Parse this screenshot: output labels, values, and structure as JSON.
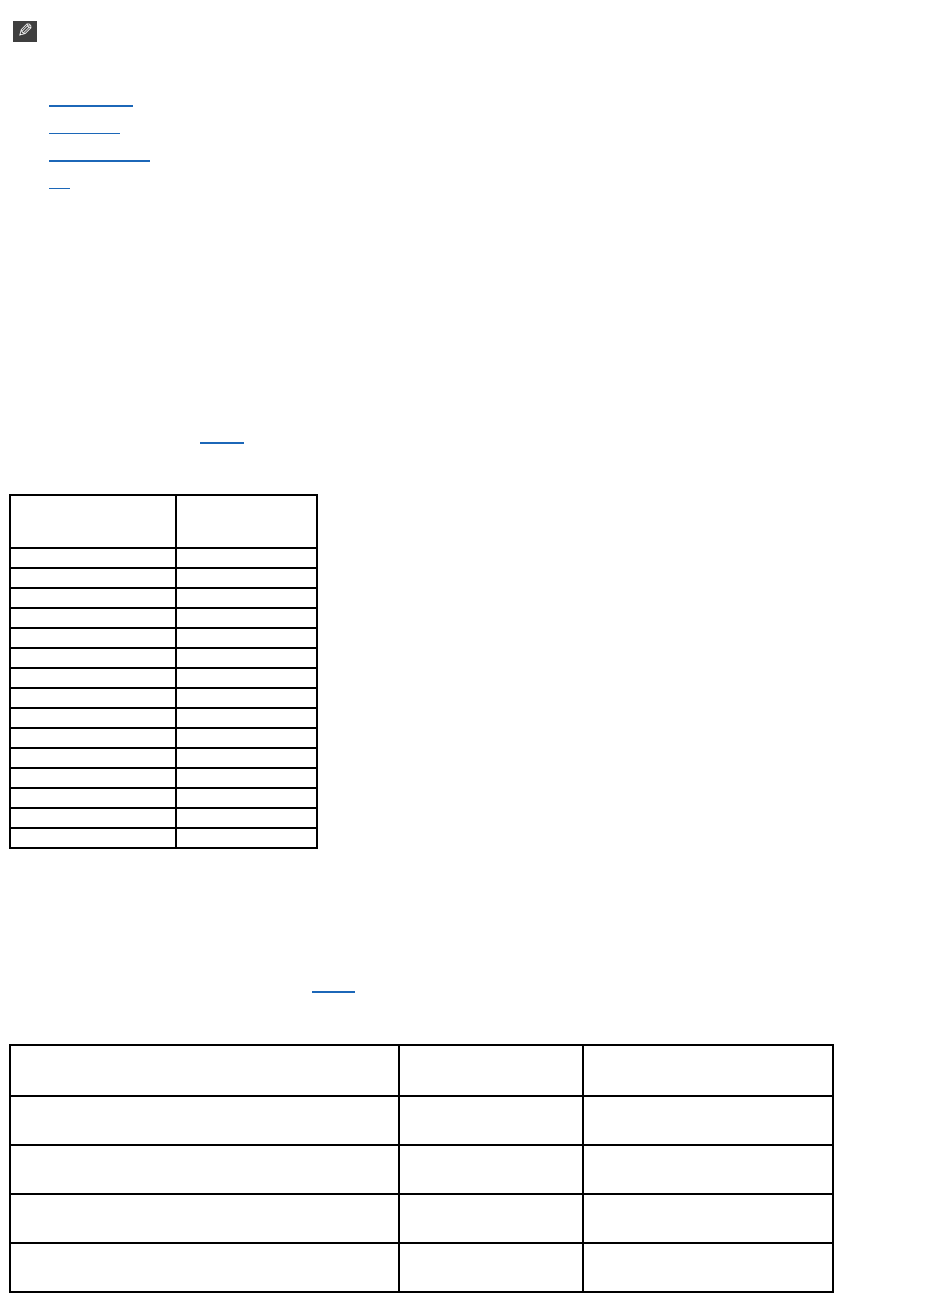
{
  "colors": {
    "link": "#1c67b8",
    "table_border": "#000000",
    "note_icon_bg": "#3f3f3f",
    "note_icon_fg": "#ffffff",
    "page_bg": "#ffffff"
  },
  "note_icon": {
    "glyph": "✎"
  },
  "nav_links": [
    {
      "label": "",
      "underline_width_px": 84
    },
    {
      "label": "",
      "underline_width_px": 71
    },
    {
      "label": "",
      "underline_width_px": 101
    },
    {
      "label": "",
      "underline_width_px": 21
    }
  ],
  "body_links": [
    {
      "label": "",
      "underline_width_px": 44
    },
    {
      "label": "",
      "underline_width_px": 43
    }
  ],
  "table1": {
    "header": [
      "",
      ""
    ],
    "rows": [
      [
        "",
        ""
      ],
      [
        "",
        ""
      ],
      [
        "",
        ""
      ],
      [
        "",
        ""
      ],
      [
        "",
        ""
      ],
      [
        "",
        ""
      ],
      [
        "",
        ""
      ],
      [
        "",
        ""
      ],
      [
        "",
        ""
      ],
      [
        "",
        ""
      ],
      [
        "",
        ""
      ],
      [
        "",
        ""
      ],
      [
        "",
        ""
      ],
      [
        "",
        ""
      ],
      [
        "",
        ""
      ]
    ]
  },
  "table2": {
    "header": [
      "",
      "",
      ""
    ],
    "rows": [
      [
        "",
        "",
        ""
      ],
      [
        "",
        "",
        ""
      ],
      [
        "",
        "",
        ""
      ],
      [
        "",
        "",
        ""
      ]
    ]
  }
}
